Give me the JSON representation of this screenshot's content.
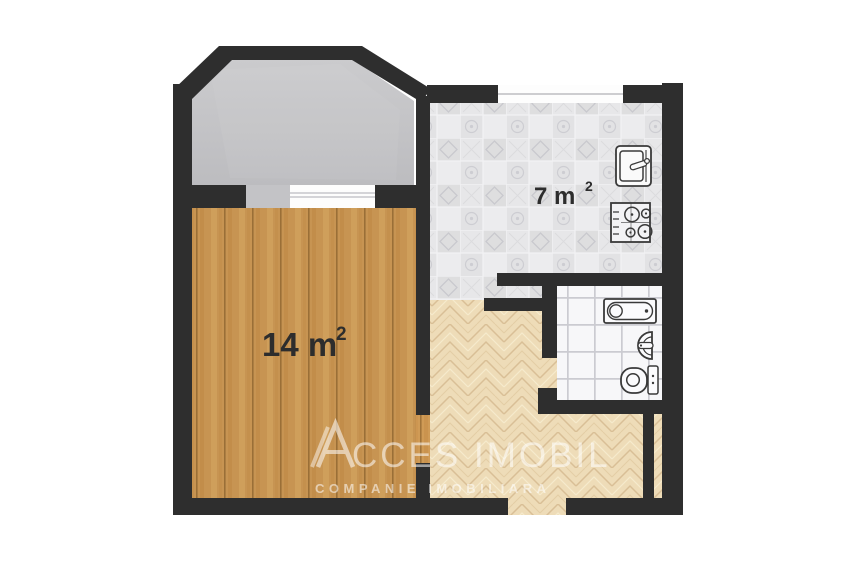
{
  "labels": {
    "living": {
      "text": "14 m",
      "sup": "2"
    },
    "kitchen": {
      "text": "7 m",
      "sup": "2"
    }
  },
  "watermark": {
    "logo_letter": "A",
    "brand_text": "CCES IMOBIL",
    "subtitle": "COMPANIE IMOBILIARA"
  },
  "rooms": [
    {
      "name": "living-room",
      "floor": "wood-planks"
    },
    {
      "name": "kitchen",
      "floor": "patterned-tile"
    },
    {
      "name": "bathroom",
      "floor": "white-tile"
    },
    {
      "name": "hallway",
      "floor": "herringbone-parquet"
    },
    {
      "name": "balcony",
      "floor": "concrete"
    }
  ],
  "fixtures": {
    "kitchen": [
      "kitchen-sink-icon",
      "stove-icon"
    ],
    "bathroom": [
      "bathtub-icon",
      "bath-sink-icon",
      "toilet-icon"
    ]
  },
  "colors": {
    "wall": "#2e2e2e",
    "wood": "#d09b56",
    "concrete": "#c6c6c8",
    "kitchen_tile": "#e4e4e7",
    "bathroom_tile": "#f6f6f8",
    "herringbone": "#eedcb8",
    "label_text": "#2d2d2d",
    "watermark": "#ffffff",
    "window": "#fdfdfd"
  }
}
